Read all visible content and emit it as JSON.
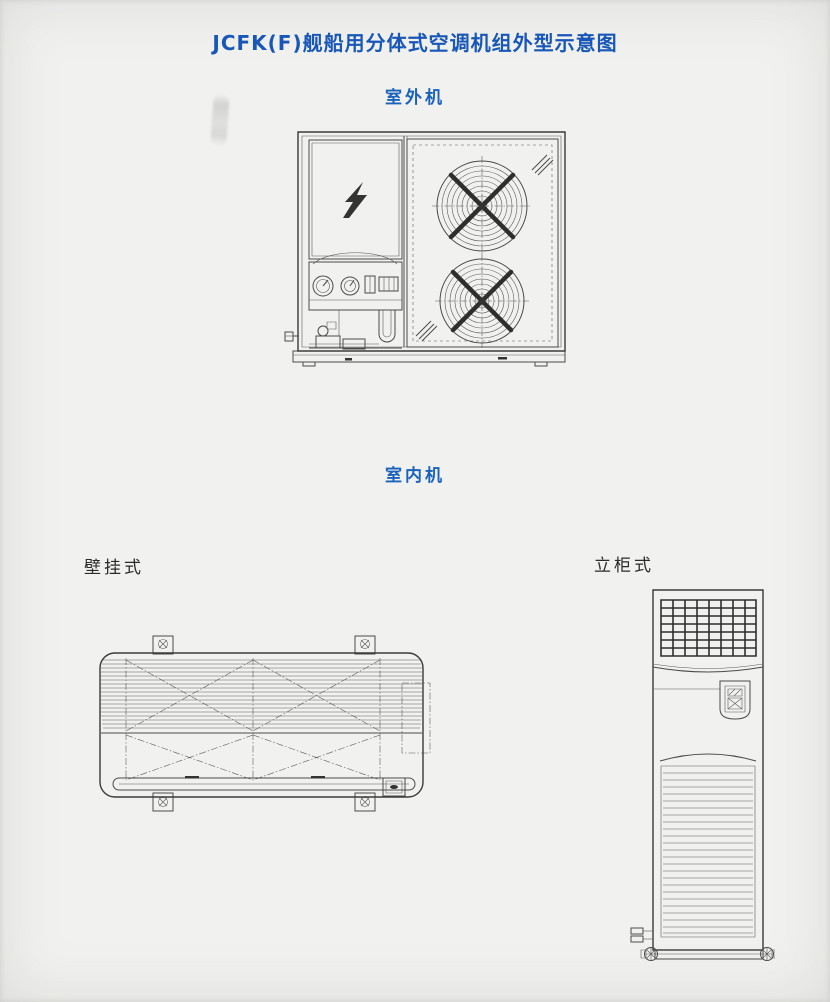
{
  "page": {
    "title": "JCFK(F)舰船用分体式空调机组外型示意图",
    "colors": {
      "title_blue": "#1857b8",
      "section_blue": "#1a62bc",
      "text_black": "#2b2b2b",
      "paper": "#f1f1ef",
      "line": "#4a4a4a"
    }
  },
  "sections": {
    "outdoor_unit_label": "室外机",
    "indoor_unit_label": "室内机",
    "wall_mounted_label": "壁挂式",
    "floor_standing_label": "立柜式"
  }
}
